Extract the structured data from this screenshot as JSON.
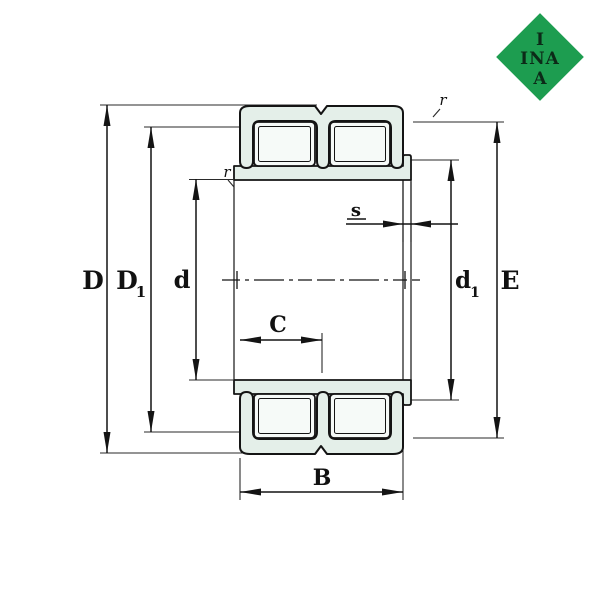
{
  "drawing": {
    "type": "cylindrical-roller-bearing-cross-section",
    "labels": {
      "D": "D",
      "D1_base": "D",
      "D1_sub": "1",
      "d": "d",
      "d1_base": "d",
      "d1_sub": "1",
      "E": "E",
      "B": "B",
      "C": "C",
      "s": "s",
      "r_left": "r",
      "r_right": "r"
    },
    "logo": {
      "top": "I",
      "middle": "INA",
      "bottom": "A"
    },
    "colors": {
      "background": "#ffffff",
      "line": "#141414",
      "ring_fill": "#e4efe9",
      "roller_fill": "#f6faf8",
      "logo_green": "#1d9d50",
      "logo_text": "#0c2a18"
    }
  }
}
